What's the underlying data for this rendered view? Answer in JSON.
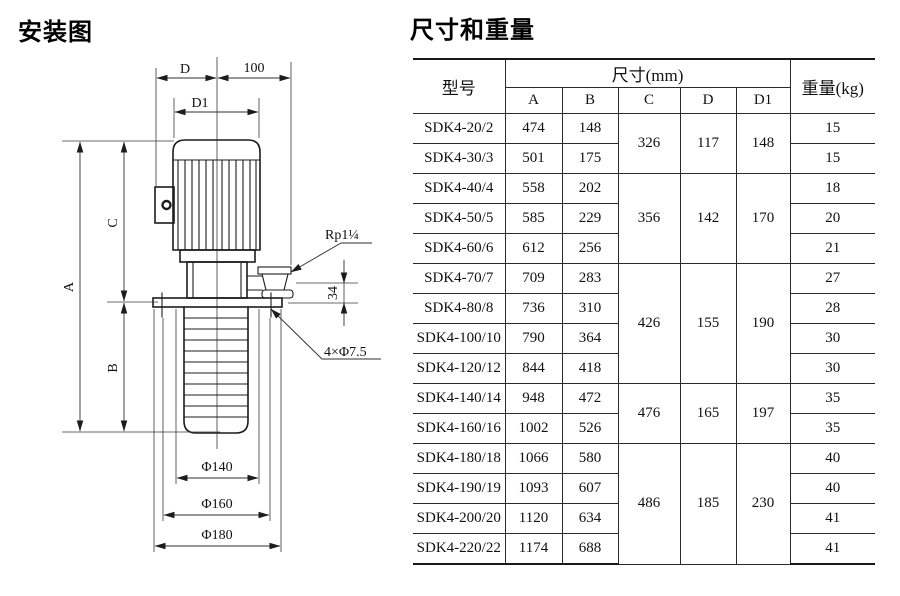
{
  "diagram": {
    "title": "安装图",
    "labels": {
      "d": "D",
      "hundred": "100",
      "d1": "D1",
      "a": "A",
      "b": "B",
      "c": "C",
      "thirty_four": "34",
      "outlet_thread": "Rp1¼",
      "flange_holes": "4×Φ7.5",
      "phi140": "Φ140",
      "phi160": "Φ160",
      "phi180": "Φ180"
    }
  },
  "table": {
    "title": "尺寸和重量",
    "header": {
      "model": "型号",
      "dims_group": "尺寸(mm)",
      "dim_cols": [
        "A",
        "B",
        "C",
        "D",
        "D1"
      ],
      "weight": "重量(kg)"
    },
    "rows": [
      {
        "model": "SDK4-20/2",
        "A": "474",
        "B": "148",
        "weight": "15",
        "group": {
          "C": "326",
          "D": "117",
          "D1": "148",
          "span": 2
        }
      },
      {
        "model": "SDK4-30/3",
        "A": "501",
        "B": "175",
        "weight": "15"
      },
      {
        "model": "SDK4-40/4",
        "A": "558",
        "B": "202",
        "weight": "18",
        "group": {
          "C": "356",
          "D": "142",
          "D1": "170",
          "span": 3
        }
      },
      {
        "model": "SDK4-50/5",
        "A": "585",
        "B": "229",
        "weight": "20"
      },
      {
        "model": "SDK4-60/6",
        "A": "612",
        "B": "256",
        "weight": "21"
      },
      {
        "model": "SDK4-70/7",
        "A": "709",
        "B": "283",
        "weight": "27",
        "group": {
          "C": "426",
          "D": "155",
          "D1": "190",
          "span": 4
        }
      },
      {
        "model": "SDK4-80/8",
        "A": "736",
        "B": "310",
        "weight": "28"
      },
      {
        "model": "SDK4-100/10",
        "A": "790",
        "B": "364",
        "weight": "30"
      },
      {
        "model": "SDK4-120/12",
        "A": "844",
        "B": "418",
        "weight": "30"
      },
      {
        "model": "SDK4-140/14",
        "A": "948",
        "B": "472",
        "weight": "35",
        "group": {
          "C": "476",
          "D": "165",
          "D1": "197",
          "span": 2
        }
      },
      {
        "model": "SDK4-160/16",
        "A": "1002",
        "B": "526",
        "weight": "35"
      },
      {
        "model": "SDK4-180/18",
        "A": "1066",
        "B": "580",
        "weight": "40",
        "group": {
          "C": "486",
          "D": "185",
          "D1": "230",
          "span": 4
        }
      },
      {
        "model": "SDK4-190/19",
        "A": "1093",
        "B": "607",
        "weight": "40"
      },
      {
        "model": "SDK4-200/20",
        "A": "1120",
        "B": "634",
        "weight": "41"
      },
      {
        "model": "SDK4-220/22",
        "A": "1174",
        "B": "688",
        "weight": "41"
      }
    ]
  }
}
